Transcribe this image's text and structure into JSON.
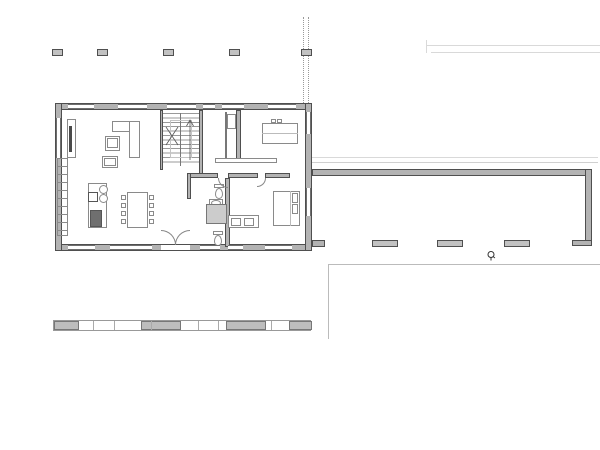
{
  "scene": {
    "kind": "architectural-floor-plan",
    "drain_symbol": "floor-drain"
  },
  "colors": {
    "wall_fill": "#b3b3b3",
    "wall_edge": "#4f4f4f",
    "furn_line": "#8a8a8a",
    "win_line": "#6e6e6e",
    "shower_fill": "#cccccc",
    "stove_fill": "#6f6f6f",
    "column_fill": "#c2c2c2",
    "light_line": "#d9d9d9",
    "paving_line": "#bbbbbb",
    "dashed_line": "#999999",
    "strip_fill": "#bdbdbd"
  },
  "plan": {
    "pergola_columns": [
      [
        52,
        49,
        11,
        7
      ],
      [
        97,
        49,
        11,
        7
      ],
      [
        163,
        49,
        11,
        7
      ],
      [
        229,
        49,
        11,
        7
      ],
      [
        301,
        49,
        11,
        7
      ]
    ],
    "carport_columns": [
      [
        372,
        240
      ],
      [
        437,
        240
      ],
      [
        504,
        240
      ]
    ],
    "windows": {
      "top": [
        [
          68,
          26
        ],
        [
          118,
          29
        ],
        [
          167,
          29
        ],
        [
          203,
          12
        ],
        [
          222,
          22
        ],
        [
          268,
          28
        ]
      ],
      "bottom": [
        [
          68,
          27
        ],
        [
          110,
          42
        ],
        [
          200,
          20
        ],
        [
          228,
          15
        ],
        [
          265,
          27
        ]
      ],
      "left": [
        [
          118,
          40
        ]
      ],
      "right": [
        [
          112,
          22
        ],
        [
          188,
          28
        ]
      ]
    },
    "strip": {
      "x": 53,
      "y": 320,
      "w": 258,
      "h": 11,
      "segments": [
        [
          0,
          25
        ],
        [
          87,
          40
        ],
        [
          172,
          40
        ],
        [
          235,
          23
        ]
      ],
      "ticks": [
        39,
        60,
        97,
        144,
        164,
        217
      ]
    },
    "dining_chairs": [
      [
        121,
        195
      ],
      [
        121,
        203
      ],
      [
        121,
        211
      ],
      [
        121,
        219
      ],
      [
        149,
        195
      ],
      [
        149,
        203
      ],
      [
        149,
        211
      ],
      [
        149,
        219
      ]
    ]
  }
}
